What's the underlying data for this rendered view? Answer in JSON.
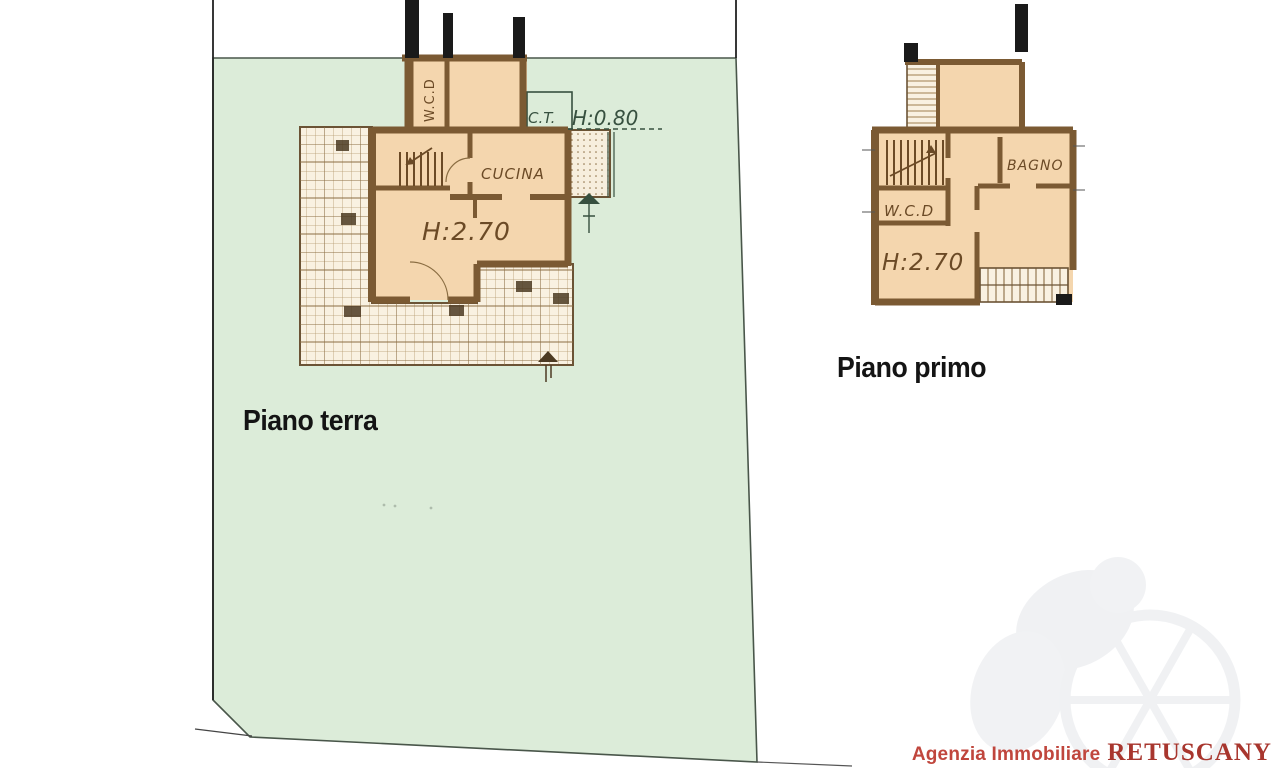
{
  "page_title": "Planimetria immobile (floor plans)",
  "colors": {
    "parcel_green": "#dcecd9",
    "room_peach": "#f4d6ae",
    "wall_brown": "#7b5a33",
    "hatch_cream": "#f9f1e1",
    "plan_green_ink": "#37503f",
    "plan_brown_ink": "#6b4a26",
    "brand_red": "#b5403a"
  },
  "ground_floor": {
    "title": "Piano terra",
    "labels": {
      "wc": "W.C.D",
      "ct": "C.T.",
      "ct_height": "H:0.80",
      "kitchen": "CUCINA",
      "room_height": "H:2.70"
    }
  },
  "first_floor": {
    "title": "Piano primo",
    "labels": {
      "bathroom": "BAGNO",
      "wc": "W.C.D",
      "room_height": "H:2.70"
    }
  },
  "footer": {
    "agency_prefix": "Agenzia Immobiliare",
    "agency_name": "RETUSCANY"
  }
}
